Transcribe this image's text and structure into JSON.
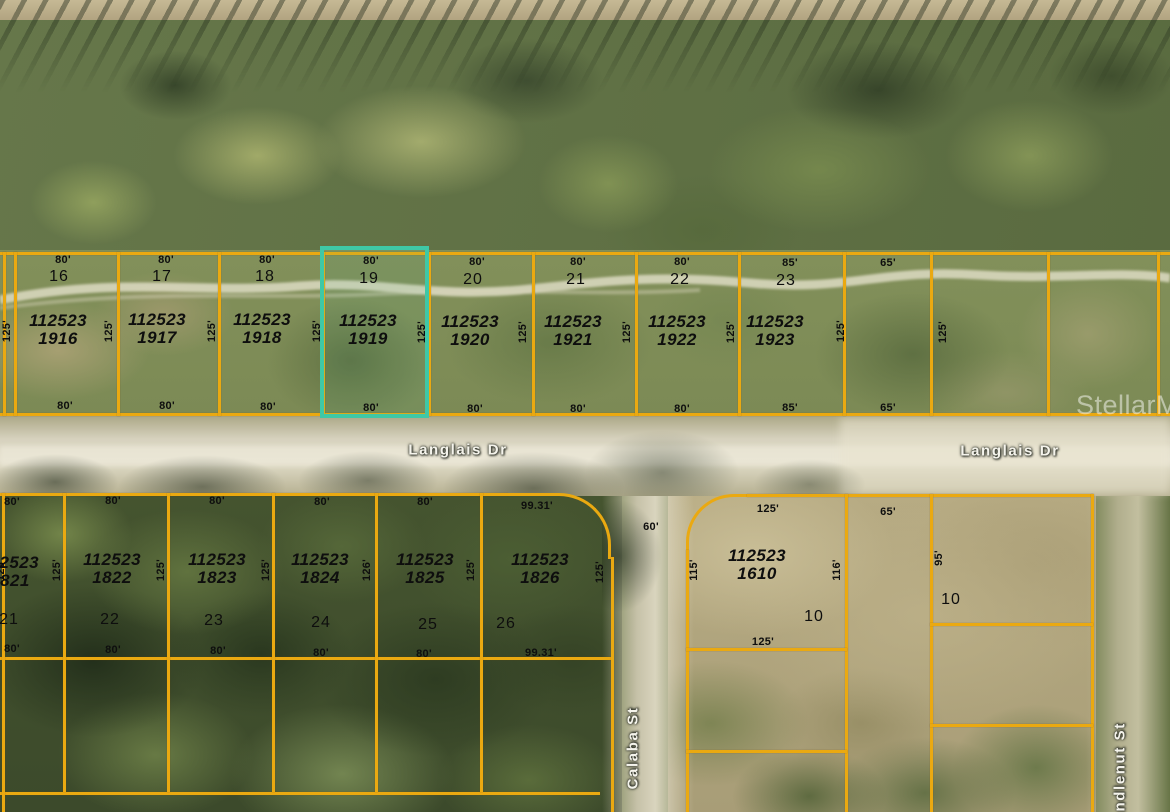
{
  "map": {
    "type": "aerial-parcel-map",
    "watermark": "StellarMLS",
    "colors": {
      "boundary": "#eaa911",
      "highlight": "#3fc8a6"
    },
    "highlighted_parcel": {
      "lot": "19",
      "parcel_id": "112523 1919"
    },
    "streets": [
      {
        "name": "Langlais Dr",
        "x": 458,
        "y": 450,
        "vertical": false
      },
      {
        "name": "Langlais Dr",
        "x": 1010,
        "y": 451,
        "vertical": false
      },
      {
        "name": "Calaba St",
        "x": 633,
        "y": 748,
        "vertical": true
      },
      {
        "name": "Candlenut St",
        "x": 1120,
        "y": 778,
        "vertical": true
      }
    ],
    "labels": [
      {
        "t": "80'",
        "x": 63,
        "y": 255,
        "c": "dim"
      },
      {
        "t": "80'",
        "x": 166,
        "y": 255,
        "c": "dim"
      },
      {
        "t": "80'",
        "x": 267,
        "y": 255,
        "c": "dim"
      },
      {
        "t": "80'",
        "x": 371,
        "y": 256,
        "c": "dim"
      },
      {
        "t": "80'",
        "x": 477,
        "y": 257,
        "c": "dim"
      },
      {
        "t": "80'",
        "x": 578,
        "y": 257,
        "c": "dim"
      },
      {
        "t": "80'",
        "x": 682,
        "y": 257,
        "c": "dim"
      },
      {
        "t": "85'",
        "x": 790,
        "y": 258,
        "c": "dim"
      },
      {
        "t": "65'",
        "x": 888,
        "y": 258,
        "c": "dim"
      },
      {
        "t": "16",
        "x": 59,
        "y": 268,
        "c": "lot"
      },
      {
        "t": "17",
        "x": 162,
        "y": 268,
        "c": "lot"
      },
      {
        "t": "18",
        "x": 265,
        "y": 268,
        "c": "lot"
      },
      {
        "t": "19",
        "x": 369,
        "y": 270,
        "c": "lot"
      },
      {
        "t": "20",
        "x": 473,
        "y": 271,
        "c": "lot"
      },
      {
        "t": "21",
        "x": 576,
        "y": 271,
        "c": "lot"
      },
      {
        "t": "22",
        "x": 680,
        "y": 271,
        "c": "lot"
      },
      {
        "t": "23",
        "x": 786,
        "y": 272,
        "c": "lot"
      },
      {
        "t": "112523\n1916",
        "x": 58,
        "y": 312,
        "c": "pid"
      },
      {
        "t": "112523\n1917",
        "x": 157,
        "y": 311,
        "c": "pid"
      },
      {
        "t": "112523\n1918",
        "x": 262,
        "y": 311,
        "c": "pid"
      },
      {
        "t": "112523\n1919",
        "x": 368,
        "y": 312,
        "c": "pid"
      },
      {
        "t": "112523\n1920",
        "x": 470,
        "y": 313,
        "c": "pid"
      },
      {
        "t": "112523\n1921",
        "x": 573,
        "y": 313,
        "c": "pid"
      },
      {
        "t": "112523\n1922",
        "x": 677,
        "y": 313,
        "c": "pid"
      },
      {
        "t": "112523\n1923",
        "x": 775,
        "y": 313,
        "c": "pid"
      },
      {
        "t": "80'",
        "x": 65,
        "y": 401,
        "c": "dim"
      },
      {
        "t": "80'",
        "x": 167,
        "y": 401,
        "c": "dim"
      },
      {
        "t": "80'",
        "x": 268,
        "y": 402,
        "c": "dim"
      },
      {
        "t": "80'",
        "x": 371,
        "y": 403,
        "c": "dim"
      },
      {
        "t": "80'",
        "x": 475,
        "y": 404,
        "c": "dim"
      },
      {
        "t": "80'",
        "x": 578,
        "y": 404,
        "c": "dim"
      },
      {
        "t": "80'",
        "x": 682,
        "y": 404,
        "c": "dim"
      },
      {
        "t": "85'",
        "x": 790,
        "y": 403,
        "c": "dim"
      },
      {
        "t": "65'",
        "x": 888,
        "y": 403,
        "c": "dim"
      },
      {
        "t": "125'",
        "x": 8,
        "y": 331,
        "c": "dimv"
      },
      {
        "t": "125'",
        "x": 110,
        "y": 331,
        "c": "dimv"
      },
      {
        "t": "125'",
        "x": 213,
        "y": 331,
        "c": "dimv"
      },
      {
        "t": "125'",
        "x": 318,
        "y": 331,
        "c": "dimv"
      },
      {
        "t": "125'",
        "x": 423,
        "y": 332,
        "c": "dimv"
      },
      {
        "t": "125'",
        "x": 524,
        "y": 332,
        "c": "dimv"
      },
      {
        "t": "125'",
        "x": 628,
        "y": 332,
        "c": "dimv"
      },
      {
        "t": "125'",
        "x": 732,
        "y": 332,
        "c": "dimv"
      },
      {
        "t": "125'",
        "x": 842,
        "y": 331,
        "c": "dimv"
      },
      {
        "t": "125'",
        "x": 944,
        "y": 332,
        "c": "dimv"
      },
      {
        "t": "80'",
        "x": 12,
        "y": 497,
        "c": "dim"
      },
      {
        "t": "80'",
        "x": 113,
        "y": 496,
        "c": "dim"
      },
      {
        "t": "80'",
        "x": 217,
        "y": 496,
        "c": "dim"
      },
      {
        "t": "80'",
        "x": 322,
        "y": 497,
        "c": "dim"
      },
      {
        "t": "80'",
        "x": 425,
        "y": 497,
        "c": "dim"
      },
      {
        "t": "99.31'",
        "x": 537,
        "y": 501,
        "c": "dim"
      },
      {
        "t": "112523\n1821",
        "x": 10,
        "y": 554,
        "c": "pid"
      },
      {
        "t": "112523\n1822",
        "x": 112,
        "y": 551,
        "c": "pid"
      },
      {
        "t": "112523\n1823",
        "x": 217,
        "y": 551,
        "c": "pid"
      },
      {
        "t": "112523\n1824",
        "x": 320,
        "y": 551,
        "c": "pid"
      },
      {
        "t": "112523\n1825",
        "x": 425,
        "y": 551,
        "c": "pid"
      },
      {
        "t": "112523\n1826",
        "x": 540,
        "y": 551,
        "c": "pid"
      },
      {
        "t": "21",
        "x": 9,
        "y": 611,
        "c": "lot"
      },
      {
        "t": "22",
        "x": 110,
        "y": 611,
        "c": "lot"
      },
      {
        "t": "23",
        "x": 214,
        "y": 612,
        "c": "lot"
      },
      {
        "t": "24",
        "x": 321,
        "y": 614,
        "c": "lot"
      },
      {
        "t": "25",
        "x": 428,
        "y": 616,
        "c": "lot"
      },
      {
        "t": "26",
        "x": 506,
        "y": 615,
        "c": "lot"
      },
      {
        "t": "80'",
        "x": 12,
        "y": 644,
        "c": "dim"
      },
      {
        "t": "80'",
        "x": 113,
        "y": 645,
        "c": "dim"
      },
      {
        "t": "80'",
        "x": 218,
        "y": 646,
        "c": "dim"
      },
      {
        "t": "80'",
        "x": 321,
        "y": 648,
        "c": "dim"
      },
      {
        "t": "80'",
        "x": 424,
        "y": 649,
        "c": "dim"
      },
      {
        "t": "99.31'",
        "x": 541,
        "y": 648,
        "c": "dim"
      },
      {
        "t": "125'",
        "x": 2,
        "y": 570,
        "c": "dimv"
      },
      {
        "t": "125'",
        "x": 58,
        "y": 570,
        "c": "dimv"
      },
      {
        "t": "125'",
        "x": 162,
        "y": 570,
        "c": "dimv"
      },
      {
        "t": "125'",
        "x": 267,
        "y": 570,
        "c": "dimv"
      },
      {
        "t": "126'",
        "x": 368,
        "y": 570,
        "c": "dimv"
      },
      {
        "t": "125'",
        "x": 472,
        "y": 570,
        "c": "dimv"
      },
      {
        "t": "125'",
        "x": 601,
        "y": 572,
        "c": "dimv"
      },
      {
        "t": "60'",
        "x": 651,
        "y": 522,
        "c": "dim"
      },
      {
        "t": "125'",
        "x": 768,
        "y": 504,
        "c": "dim"
      },
      {
        "t": "112523\n1610",
        "x": 757,
        "y": 547,
        "c": "pid"
      },
      {
        "t": "115'",
        "x": 695,
        "y": 570,
        "c": "dimv"
      },
      {
        "t": "116'",
        "x": 838,
        "y": 570,
        "c": "dimv"
      },
      {
        "t": "10",
        "x": 814,
        "y": 608,
        "c": "lot"
      },
      {
        "t": "125'",
        "x": 763,
        "y": 637,
        "c": "dim"
      },
      {
        "t": "65'",
        "x": 888,
        "y": 507,
        "c": "dim"
      },
      {
        "t": "95'",
        "x": 940,
        "y": 558,
        "c": "dimv"
      },
      {
        "t": "10",
        "x": 951,
        "y": 591,
        "c": "lot"
      }
    ]
  }
}
